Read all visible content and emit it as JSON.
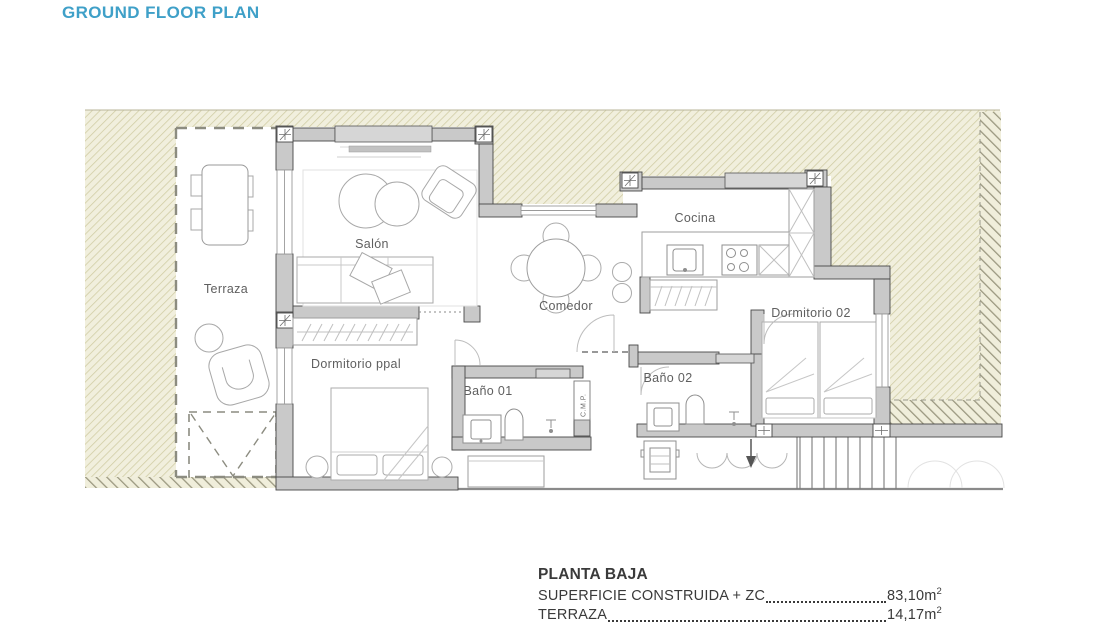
{
  "title": "GROUND FLOOR PLAN",
  "plan": {
    "rooms": [
      {
        "label": "Terraza"
      },
      {
        "label": "Salón"
      },
      {
        "label": "Comedor"
      },
      {
        "label": "Cocina"
      },
      {
        "label": "Dormitorio ppal"
      },
      {
        "label": "Baño 01"
      },
      {
        "label": "Baño 02"
      },
      {
        "label": "Dormitorio 02"
      },
      {
        "label": "C.M.P."
      }
    ]
  },
  "legend": {
    "title": "PLANTA BAJA",
    "rows": [
      {
        "label": "SUPERFICIE CONSTRUIDA + ZC",
        "value": "83,10",
        "unit": "m",
        "sup": "2"
      },
      {
        "label": "TERRAZA",
        "value": "14,17",
        "unit": "m",
        "sup": "2"
      }
    ]
  },
  "colors": {
    "title_accent": "#3FA0C8",
    "wall_fill": "#C9C9C9",
    "window_fill": "#D6D6D6",
    "hatch_background": "#F1EFDD",
    "hatch_fine_line": "#CFCBA2",
    "hatch_coarse_line": "#9B9880",
    "room_label_text": "#5F5F5F",
    "legend_text": "#3A3A3A"
  }
}
